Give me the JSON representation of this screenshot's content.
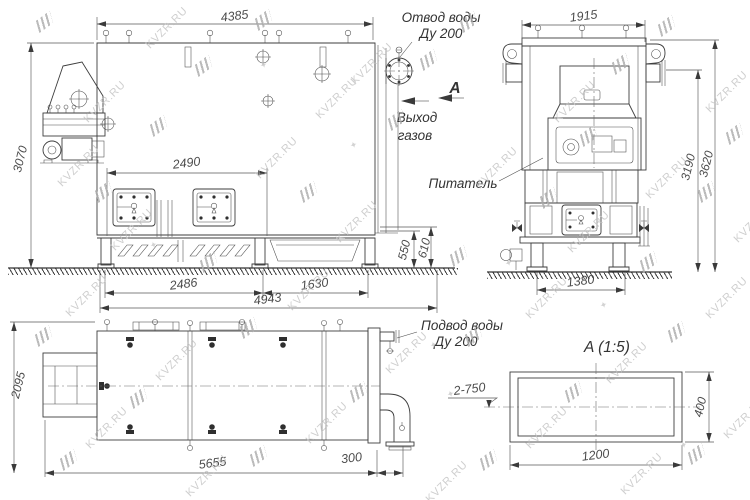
{
  "watermark": {
    "text": "KVZR.RU",
    "instances": [
      [
        140,
        22,
        "t"
      ],
      [
        345,
        58,
        "t"
      ],
      [
        78,
        96,
        "t"
      ],
      [
        310,
        92,
        "t"
      ],
      [
        548,
        96,
        "t"
      ],
      [
        700,
        86,
        "t"
      ],
      [
        52,
        160,
        "t"
      ],
      [
        250,
        152,
        "t"
      ],
      [
        470,
        162,
        "t"
      ],
      [
        640,
        172,
        "t"
      ],
      [
        105,
        224,
        "t"
      ],
      [
        330,
        216,
        "t"
      ],
      [
        562,
        226,
        "t"
      ],
      [
        728,
        216,
        "t"
      ],
      [
        60,
        290,
        "t"
      ],
      [
        282,
        284,
        "t"
      ],
      [
        520,
        292,
        "t"
      ],
      [
        700,
        292,
        "t"
      ],
      [
        150,
        354,
        "t"
      ],
      [
        380,
        347,
        "t"
      ],
      [
        600,
        357,
        "t"
      ],
      [
        80,
        422,
        "t"
      ],
      [
        300,
        417,
        "t"
      ],
      [
        520,
        422,
        "t"
      ],
      [
        718,
        412,
        "t"
      ],
      [
        180,
        470,
        "t"
      ],
      [
        420,
        476,
        "t"
      ],
      [
        615,
        468,
        "t"
      ],
      [
        36,
        16,
        "l"
      ],
      [
        255,
        14,
        "l"
      ],
      [
        460,
        16,
        "l"
      ],
      [
        658,
        20,
        "l"
      ],
      [
        195,
        60,
        "l"
      ],
      [
        420,
        54,
        "l"
      ],
      [
        612,
        58,
        "l"
      ],
      [
        150,
        120,
        "l"
      ],
      [
        388,
        114,
        "l"
      ],
      [
        580,
        130,
        "l"
      ],
      [
        726,
        128,
        "l"
      ],
      [
        95,
        186,
        "l"
      ],
      [
        300,
        186,
        "l"
      ],
      [
        540,
        192,
        "l"
      ],
      [
        698,
        186,
        "l"
      ],
      [
        200,
        256,
        "l"
      ],
      [
        450,
        250,
        "l"
      ],
      [
        640,
        256,
        "l"
      ],
      [
        35,
        330,
        "l"
      ],
      [
        240,
        322,
        "l"
      ],
      [
        465,
        330,
        "l"
      ],
      [
        668,
        326,
        "l"
      ],
      [
        130,
        392,
        "l"
      ],
      [
        350,
        386,
        "l"
      ],
      [
        565,
        386,
        "l"
      ],
      [
        60,
        454,
        "l"
      ],
      [
        250,
        450,
        "l"
      ],
      [
        480,
        454,
        "l"
      ],
      [
        688,
        448,
        "l"
      ],
      [
        447,
        389,
        "s"
      ],
      [
        505,
        258,
        "s"
      ],
      [
        350,
        140,
        "s"
      ],
      [
        600,
        300,
        "s"
      ],
      [
        150,
        240,
        "s"
      ],
      [
        680,
        440,
        "s"
      ],
      [
        260,
        60,
        "s"
      ],
      [
        430,
        340,
        "s"
      ]
    ]
  },
  "front_view": {
    "dims": {
      "overall_width": "4385",
      "overall_height": "3070",
      "hatch_span": "2490",
      "base_left": "2486",
      "base_right": "1630",
      "base_total": "4943",
      "right_inner": "550",
      "right_outer": "610"
    },
    "labels": {
      "water_outlet_line1": "Отвод воды",
      "water_outlet_line2": "Ду 200",
      "gas_outlet_line1": "Выход",
      "gas_outlet_line2": "газов",
      "section_marker": "A"
    }
  },
  "side_view": {
    "dims": {
      "overall_width": "1915",
      "height_inner": "3190",
      "height_outer": "3620",
      "base_width": "1380"
    },
    "labels": {
      "feeder": "Питатель"
    }
  },
  "plan_view": {
    "dims": {
      "overall_depth": "2095",
      "overall_length": "5655",
      "pipe_offset": "300"
    },
    "labels": {
      "water_inlet_line1": "Подвод воды",
      "water_inlet_line2": "Ду 200"
    }
  },
  "detail_view": {
    "title": "A  (1:5)",
    "dims": {
      "width": "1200",
      "height": "400"
    },
    "note": "2-750"
  }
}
